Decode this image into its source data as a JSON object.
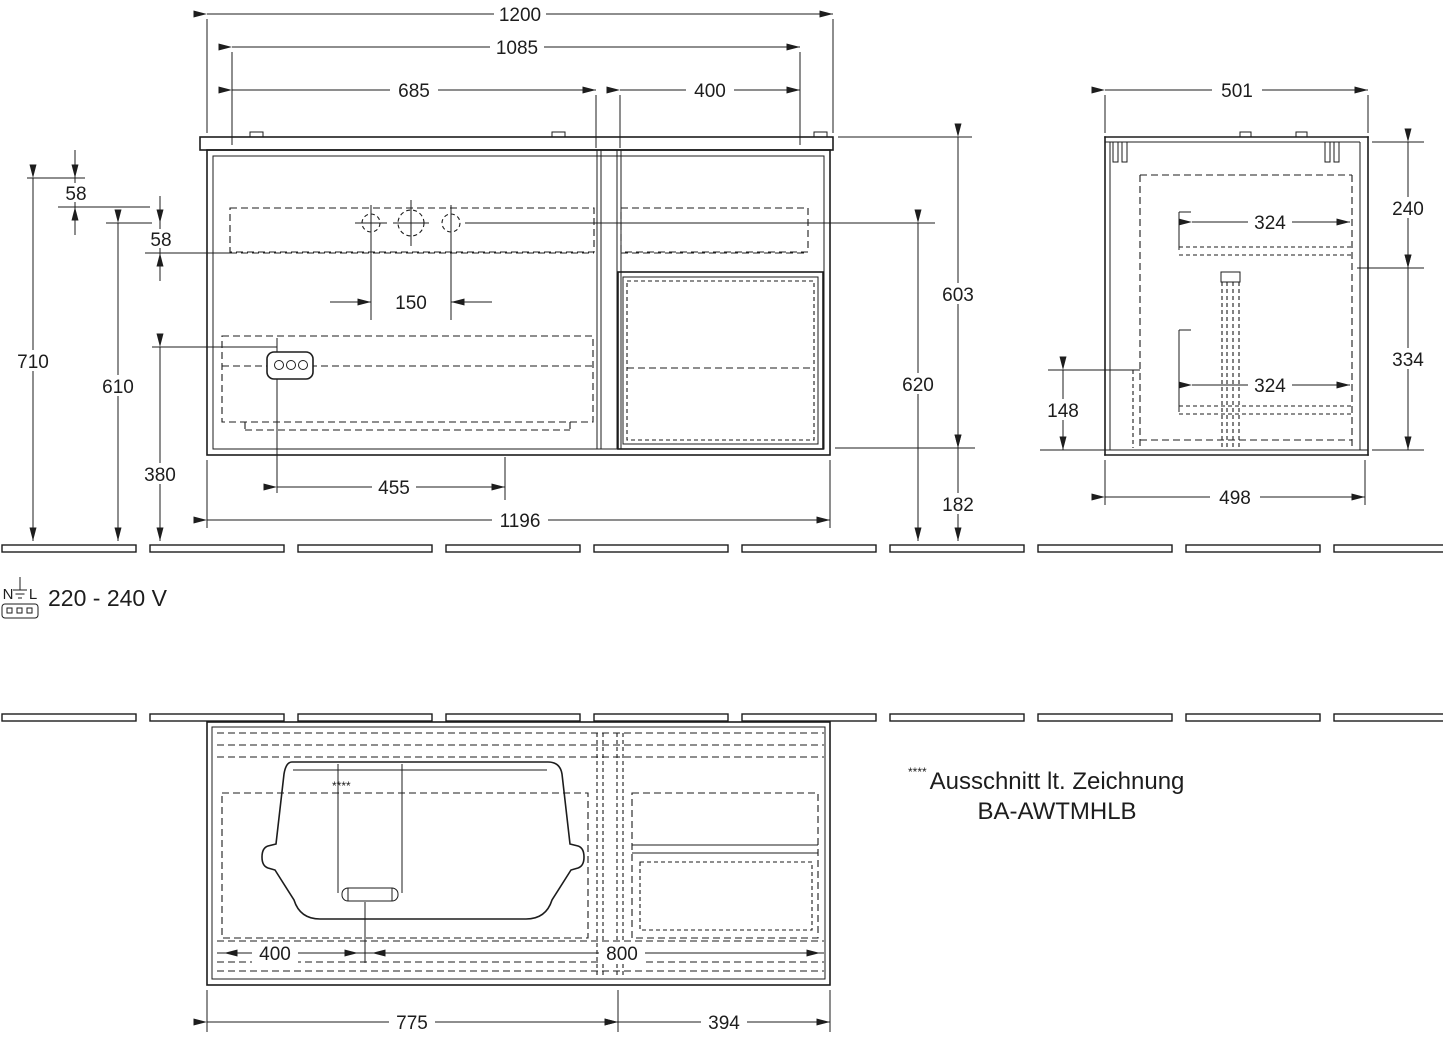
{
  "front": {
    "width_total": "1200",
    "width_inner": "1085",
    "width_left": "685",
    "width_right": "400",
    "offset_top": "58",
    "offset_hole": "58",
    "height_total": "710",
    "height_hole": "610",
    "height_socket": "380",
    "hole_spacing": "150",
    "drawer_width": "455",
    "body_width": "1196",
    "height_right_top": "603",
    "height_hole_floor": "620",
    "height_bottom_gap": "182"
  },
  "side": {
    "depth_total": "501",
    "height_upper": "240",
    "shelf_depth_upper": "324",
    "shelf_depth_lower": "324",
    "height_lower": "334",
    "height_plinth": "148",
    "depth_bottom": "498"
  },
  "plan": {
    "basin_offset": "400",
    "center_offset": "800",
    "width_left": "775",
    "width_right": "394",
    "cutout_marker": "****"
  },
  "electrical": {
    "terminal_n": "N",
    "terminal_l": "L",
    "voltage": "220 - 240 V"
  },
  "note": {
    "marker": "****",
    "line1": "Ausschnitt lt. Zeichnung",
    "line2": "BA-AWTMHLB"
  }
}
